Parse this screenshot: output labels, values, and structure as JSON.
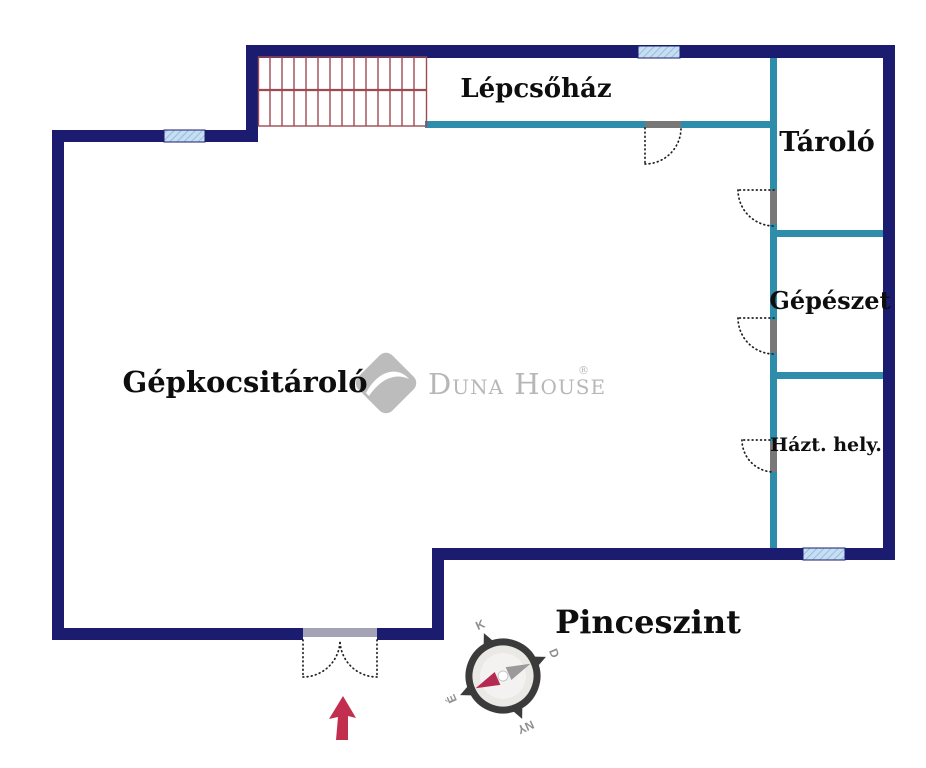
{
  "floor_plan": {
    "title": "Pinceszint",
    "rooms": {
      "lepcsohaz": "Lépcsőház",
      "tarolo": "Tároló",
      "gepeszet": "Gépészet",
      "hazt_hely": "Házt. hely.",
      "gepkocsitarolo": "Gépkocsitároló"
    },
    "compass": {
      "north": "É",
      "east": "K",
      "south": "D",
      "west": "NY"
    },
    "watermark": {
      "brand": "Duna House",
      "registered": "®"
    }
  },
  "colors": {
    "wall": "#1b1b70",
    "partition": "#2f8dac",
    "stairs": "#9e4a52",
    "window_fill": "#c7def2",
    "window_hatch": "#7fafd6",
    "jamb": "#787878",
    "door": "#1f1f1f",
    "door_bar": "#a3a3b5",
    "arrow": "#c22f4e",
    "logo": "#bcbcbc",
    "logo_text": "#b7b7b7",
    "label": "#0e0e0e",
    "compass_dark": "#3b3b3b",
    "compass_face": "#ebe9e6",
    "compass_letter": "#8e8e8e",
    "needle_gray": "#9a9a9a",
    "needle_red": "#b52a50"
  }
}
